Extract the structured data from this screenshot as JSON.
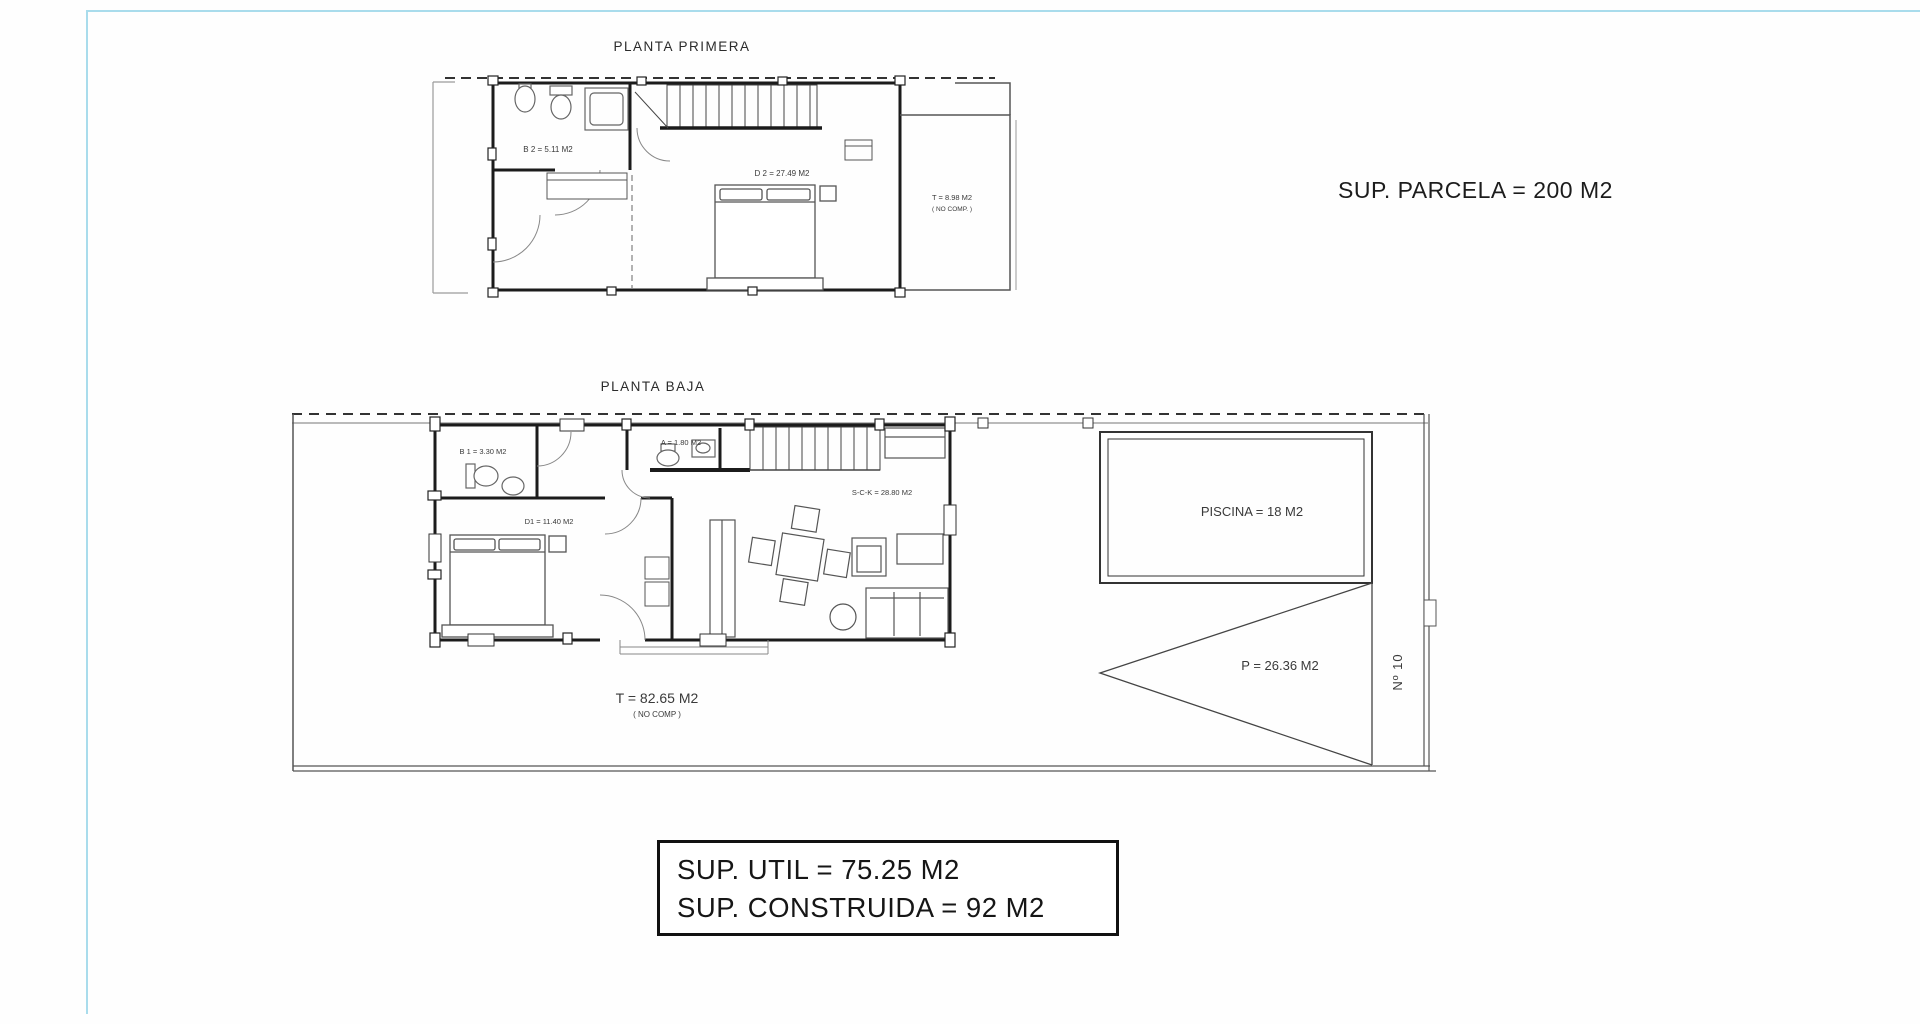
{
  "page": {
    "background": "#fefefe",
    "guide_line_color": "#a9dcec",
    "wall_color": "#1b1b1b"
  },
  "planta_primera": {
    "title": "PLANTA PRIMERA",
    "labels": {
      "b2": "B 2 = 5.11 M2",
      "d2": "D 2 = 27.49 M2",
      "terraza_line1": "T = 8.98 M2",
      "terraza_line2": "( NO COMP. )"
    }
  },
  "planta_baja": {
    "title": "PLANTA BAJA",
    "labels": {
      "b1": "B 1 = 3.30 M2",
      "aseo": "A = 1.80 M2",
      "d1": "D1 = 11.40 M2",
      "salon_cocina": "S-C-K = 28.80 M2",
      "terraza_line1": "T = 82.65 M2",
      "terraza_line2": "( NO COMP )",
      "piscina": "PISCINA = 18 M2",
      "parking": "P = 26.36 M2",
      "numero": "Nº 10"
    }
  },
  "annotations": {
    "parcela": "SUP. PARCELA = 200 M2",
    "summary_line1": "SUP. UTIL = 75.25 M2",
    "summary_line2": "SUP. CONSTRUIDA = 92 M2"
  }
}
